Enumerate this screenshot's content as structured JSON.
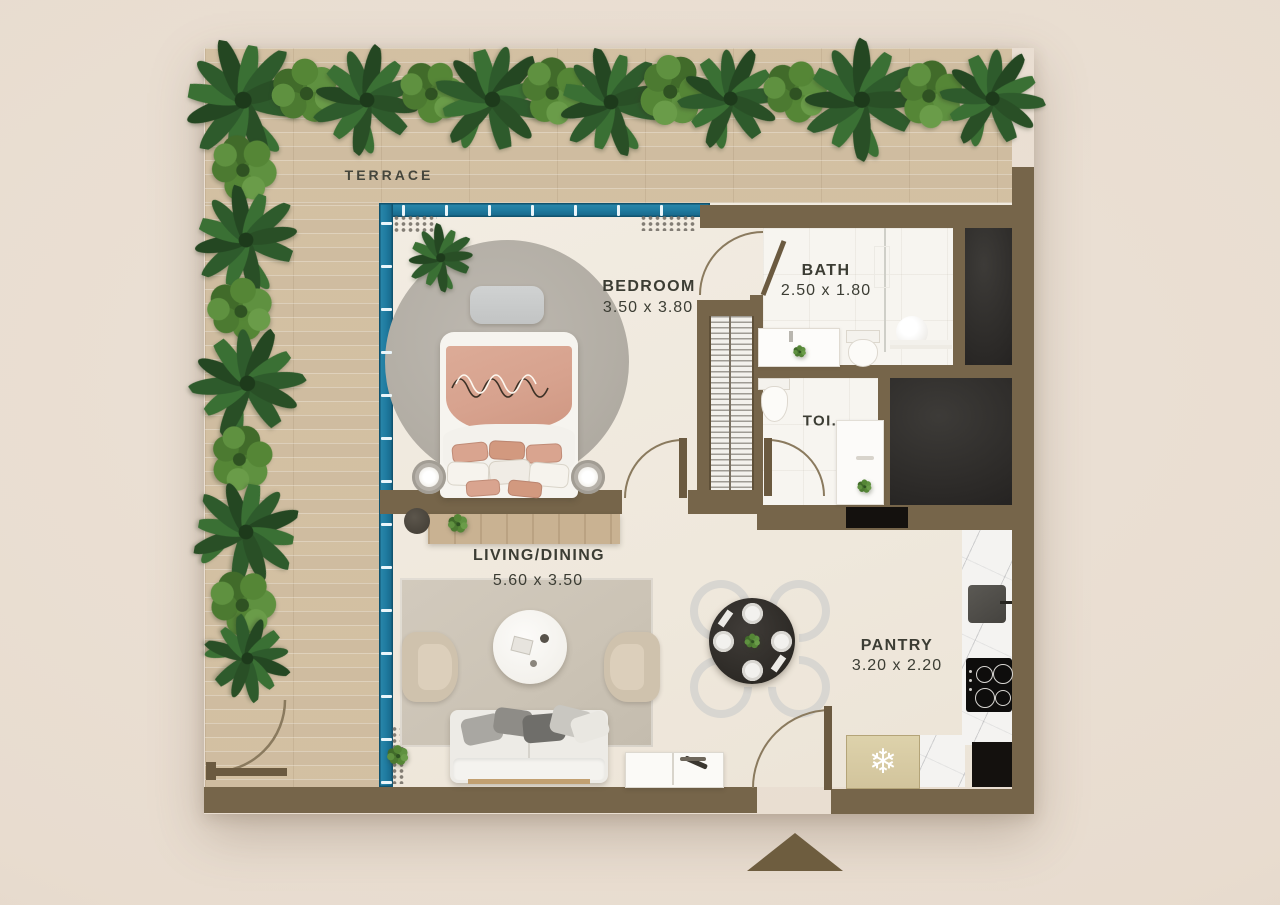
{
  "meta": {
    "type": "apartment-floor-plan"
  },
  "rooms": {
    "terrace": {
      "name": "TERRACE"
    },
    "bedroom": {
      "name": "BEDROOM",
      "size": "3.50 x 3.80"
    },
    "bath": {
      "name": "BATH",
      "size": "2.50 x 1.80"
    },
    "toilet": {
      "name": "TOI."
    },
    "living": {
      "name": "LIVING/DINING",
      "size": "5.60 x 3.50"
    },
    "pantry": {
      "name": "PANTRY",
      "size": "3.20 x 2.20"
    }
  },
  "icons": {
    "fridge_snowflake": "❄"
  },
  "colors": {
    "background": "#e9ddd2",
    "terrace_wood": "#d9c7ab",
    "interior_floor": "#f1ebe0",
    "wall": "#76654a",
    "window_frame": "#1f7ba0",
    "dark_cabinet": "#2d2b29",
    "bed_accent": "#d7a28e",
    "plant_green": "#3f6b2f",
    "marble": "#f4f3f1"
  }
}
